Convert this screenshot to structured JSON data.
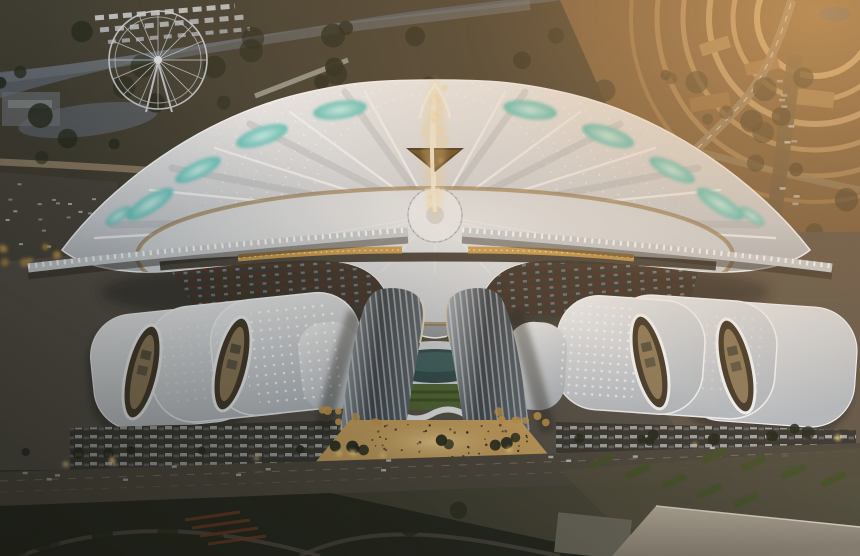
{
  "scene": {
    "type": "aerial-architectural-rendering",
    "subject": "futuristic exhibition and convention center complex at dusk",
    "elements": {
      "fan_hall": "fan-shaped central exhibition hall with radiating white roof, teal skylights and golden central spire",
      "twin_towers": "two curved glass hotel towers flanking a sunken oval courtyard",
      "side_halls": "white wave-roof exhibition halls with oval courtyards and dot lights",
      "ferris_wheel": "ferris wheel by the river in the upper left",
      "river": "river crossing the upper part of the scene",
      "ring_roads": "concentric ring roads in the upper right",
      "plaza": "warm-lit pedestrian plaza with people between the towers",
      "highway": "main road with cars and street lamps across the bottom"
    }
  },
  "palette": {
    "bg_dark": "#32342b",
    "bg_mid": "#54503f",
    "bg_warm": "#8f7049",
    "land_top": "#3e3c31",
    "river": "#565c62",
    "water_sheen": "#6d747a",
    "roof_light": "#edeff1",
    "roof_mid": "#c9ced4",
    "roof_shadow": "#8e959d",
    "apron_light": "#e4e7ea",
    "apron_dark": "#c2c8cf",
    "rib_white": "#f4f6f8",
    "teal_core": "#c9f2ee",
    "teal_edge": "#5fc2bc",
    "gold_light": "#f4d289",
    "gold_mid": "#c79a4e",
    "gold_deep": "#8a6832",
    "tower_light": "#a9b4bd",
    "tower_dark": "#3c454e",
    "stripe_white": "#ffffff",
    "lawn": "#4d6436",
    "court_teal": "#2d4a4d",
    "tree_dark": "#262a1e",
    "tree_warm": "#46402e",
    "road_dark": "#4f4a40",
    "road_tan": "#93836a",
    "arc_tan": "#d8b88a",
    "plaza_warm": "#c7a160",
    "plaza_glow": "#eed092",
    "dock": "#3a3933",
    "buslot_red": "#7c3f24",
    "truck_light": "#c7cacd",
    "island_green": "#47532c",
    "br_roof": "#b7ad9c",
    "shadow": "#1e1f1a",
    "white_dot": "#ffffff",
    "people": "#322e27",
    "ferris": "#c5cad0",
    "car_amber": "#d99a4a"
  },
  "scatter": {
    "groups": [
      {
        "id": "trees-topleft",
        "seed": 7,
        "n": 28,
        "x": 0,
        "y": 28,
        "w": 560,
        "h": 130,
        "rmin": 5,
        "rmax": 13,
        "color": "tree_dark",
        "omin": 0.5,
        "omax": 0.9
      },
      {
        "id": "trees-topright",
        "seed": 11,
        "n": 24,
        "x": 600,
        "y": 60,
        "w": 250,
        "h": 190,
        "rmin": 5,
        "rmax": 12,
        "color": "tree_warm",
        "omin": 0.5,
        "omax": 0.85
      },
      {
        "id": "spire-sparkles",
        "seed": 3,
        "n": 28,
        "x": 420,
        "y": 86,
        "w": 28,
        "h": 128,
        "rmin": 0.8,
        "rmax": 2.1,
        "color": "gold_light",
        "omin": 0.5,
        "omax": 1
      },
      {
        "id": "people-plaza",
        "seed": 19,
        "n": 46,
        "x": 345,
        "y": 424,
        "w": 185,
        "h": 38,
        "rmin": 0.8,
        "rmax": 1.4,
        "color": "people",
        "omin": 0.6,
        "omax": 0.95
      },
      {
        "id": "lamps-road",
        "seed": 23,
        "n": 11,
        "x": 15,
        "y": 462,
        "w": 830,
        "h": 5,
        "slope": -0.03,
        "rmin": 2.4,
        "rmax": 3.4,
        "color": "gold_light",
        "omin": 0.5,
        "omax": 0.85
      },
      {
        "id": "trees-road",
        "seed": 29,
        "n": 24,
        "x": 5,
        "y": 452,
        "w": 850,
        "h": 9,
        "slope": -0.03,
        "rmin": 4,
        "rmax": 7,
        "color": "tree_dark",
        "omin": 0.75,
        "omax": 1
      },
      {
        "id": "cars-road",
        "seed": 31,
        "n": 14,
        "x": 20,
        "y": 470,
        "w": 820,
        "h": 13,
        "slope": -0.033,
        "shape": "rect",
        "rw": 5,
        "rh": 2.4,
        "color": "truck_light",
        "omin": 0.7,
        "omax": 1
      },
      {
        "id": "trees-park",
        "seed": 37,
        "n": 15,
        "x": 10,
        "y": 505,
        "w": 560,
        "h": 45,
        "rmin": 6,
        "rmax": 12,
        "color": "tree_dark",
        "omin": 0.6,
        "omax": 0.9
      },
      {
        "id": "trees-court",
        "seed": 41,
        "n": 10,
        "x": 384,
        "y": 332,
        "w": 104,
        "h": 18,
        "rmin": 4,
        "rmax": 6,
        "color": "island_green",
        "omin": 0.8,
        "omax": 1
      },
      {
        "id": "ytrees-plaza-left",
        "seed": 43,
        "n": 7,
        "x": 322,
        "y": 410,
        "w": 58,
        "h": 13,
        "rmin": 3,
        "rmax": 4.5,
        "color": "gold_mid",
        "omin": 0.75,
        "omax": 0.95
      },
      {
        "id": "ytrees-plaza-right",
        "seed": 47,
        "n": 7,
        "x": 490,
        "y": 410,
        "w": 58,
        "h": 13,
        "rmin": 3,
        "rmax": 4.5,
        "color": "gold_mid",
        "omin": 0.75,
        "omax": 0.95
      },
      {
        "id": "ytrees-west",
        "seed": 53,
        "n": 12,
        "x": 2,
        "y": 240,
        "w": 185,
        "h": 28,
        "rmin": 3,
        "rmax": 4.6,
        "color": "gold_mid",
        "omin": 0.6,
        "omax": 0.9
      },
      {
        "id": "cars-westlot",
        "seed": 59,
        "n": 18,
        "x": 4,
        "y": 178,
        "w": 106,
        "h": 68,
        "shape": "rect",
        "rw": 4,
        "rh": 2,
        "color": "truck_light",
        "omin": 0.5,
        "omax": 0.85
      },
      {
        "id": "trucks-eastroad",
        "seed": 61,
        "n": 11,
        "x": 772,
        "y": 72,
        "w": 36,
        "h": 168,
        "shape": "rect",
        "rw": 6,
        "rh": 2.5,
        "color": "truck_light",
        "omin": 0.5,
        "omax": 0.85
      }
    ]
  }
}
